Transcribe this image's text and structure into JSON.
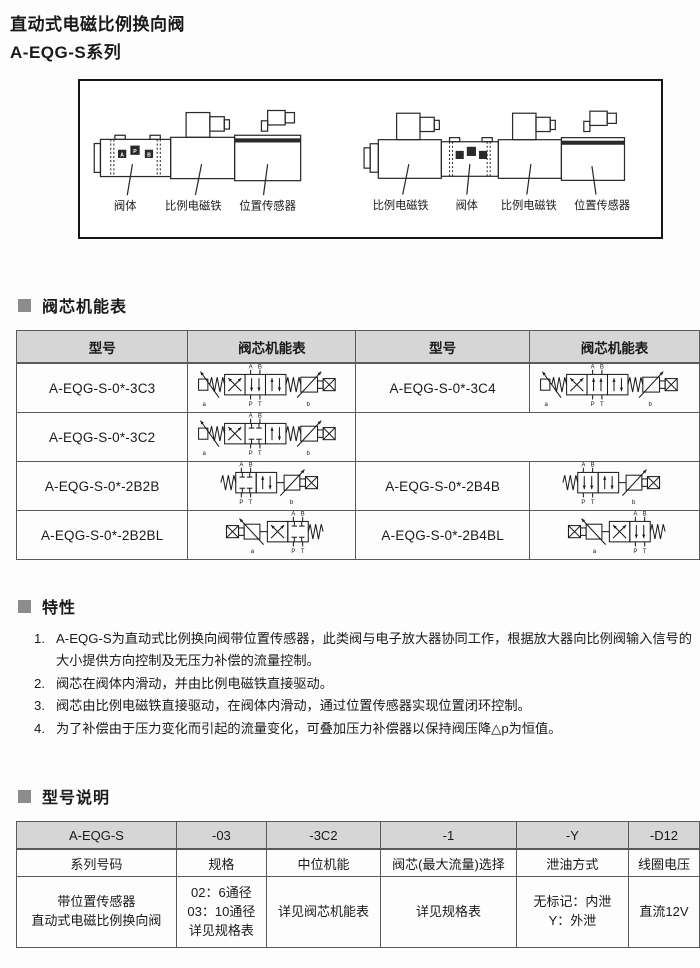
{
  "title": {
    "line1": "直动式电磁比例换向阀",
    "line2": "A-EQG-S系列"
  },
  "figure": {
    "left_labels": [
      "阀体",
      "比例电磁铁",
      "位置传感器"
    ],
    "right_labels": [
      "比例电磁铁",
      "阀体",
      "比例电磁铁",
      "位置传感器"
    ],
    "port_letters": [
      "A",
      "P",
      "B"
    ]
  },
  "sections": {
    "spool": "阀芯机能表",
    "features": "特性",
    "model": "型号说明"
  },
  "spool_table": {
    "headers": [
      "型号",
      "阀芯机能表",
      "型号",
      "阀芯机能表"
    ],
    "rows": [
      {
        "left_model": "A-EQG-S-0*-3C3",
        "left_symbol": "3C3",
        "right_model": "A-EQG-S-0*-3C4",
        "right_symbol": "3C4"
      },
      {
        "left_model": "A-EQG-S-0*-3C2",
        "left_symbol": "3C2",
        "right_model": "",
        "right_symbol": ""
      },
      {
        "left_model": "A-EQG-S-0*-2B2B",
        "left_symbol": "2B2B",
        "right_model": "A-EQG-S-0*-2B4B",
        "right_symbol": "2B4B"
      },
      {
        "left_model": "A-EQG-S-0*-2B2BL",
        "left_symbol": "2B2BL",
        "right_model": "A-EQG-S-0*-2B4BL",
        "right_symbol": "2B4BL"
      }
    ],
    "port_labels": {
      "top": [
        "A",
        "B"
      ],
      "bottom": [
        "P",
        "T"
      ],
      "end_left": "a",
      "end_right": "b"
    }
  },
  "features": {
    "items": [
      {
        "num": "1.",
        "text": "A-EQG-S为直动式比例换向阀带位置传感器，此类阀与电子放大器协同工作，根据放大器向比例阀输入信号的大小提供方向控制及无压力补偿的流量控制。"
      },
      {
        "num": "2.",
        "text": "阀芯在阀体内滑动，并由比例电磁铁直接驱动。"
      },
      {
        "num": "3.",
        "text": "阀芯由比例电磁铁直接驱动，在阀体内滑动，通过位置传感器实现位置闭环控制。"
      },
      {
        "num": "4.",
        "text": "为了补偿由于压力变化而引起的流量变化，可叠加压力补偿器以保持阀压降△p为恒值。"
      }
    ]
  },
  "model_table": {
    "codes": [
      "A-EQG-S",
      "-03",
      "-3C2",
      "-1",
      "-Y",
      "-D12"
    ],
    "labels": [
      "系列号码",
      "规格",
      "中位机能",
      "阀芯(最大流量)选择",
      "泄油方式",
      "线圈电压"
    ],
    "descs": [
      "带位置传感器\n直动式电磁比例换向阀",
      "02：6通径\n03：10通径\n详见规格表",
      "详见阀芯机能表",
      "详见规格表",
      "无标记：内泄\nY：外泄",
      "直流12V"
    ]
  },
  "colors": {
    "header_bg": "#d6d6d6",
    "table_border": "#5a5a5a",
    "section_bullet": "#8c8c8c",
    "text": "#1a1a1a"
  }
}
